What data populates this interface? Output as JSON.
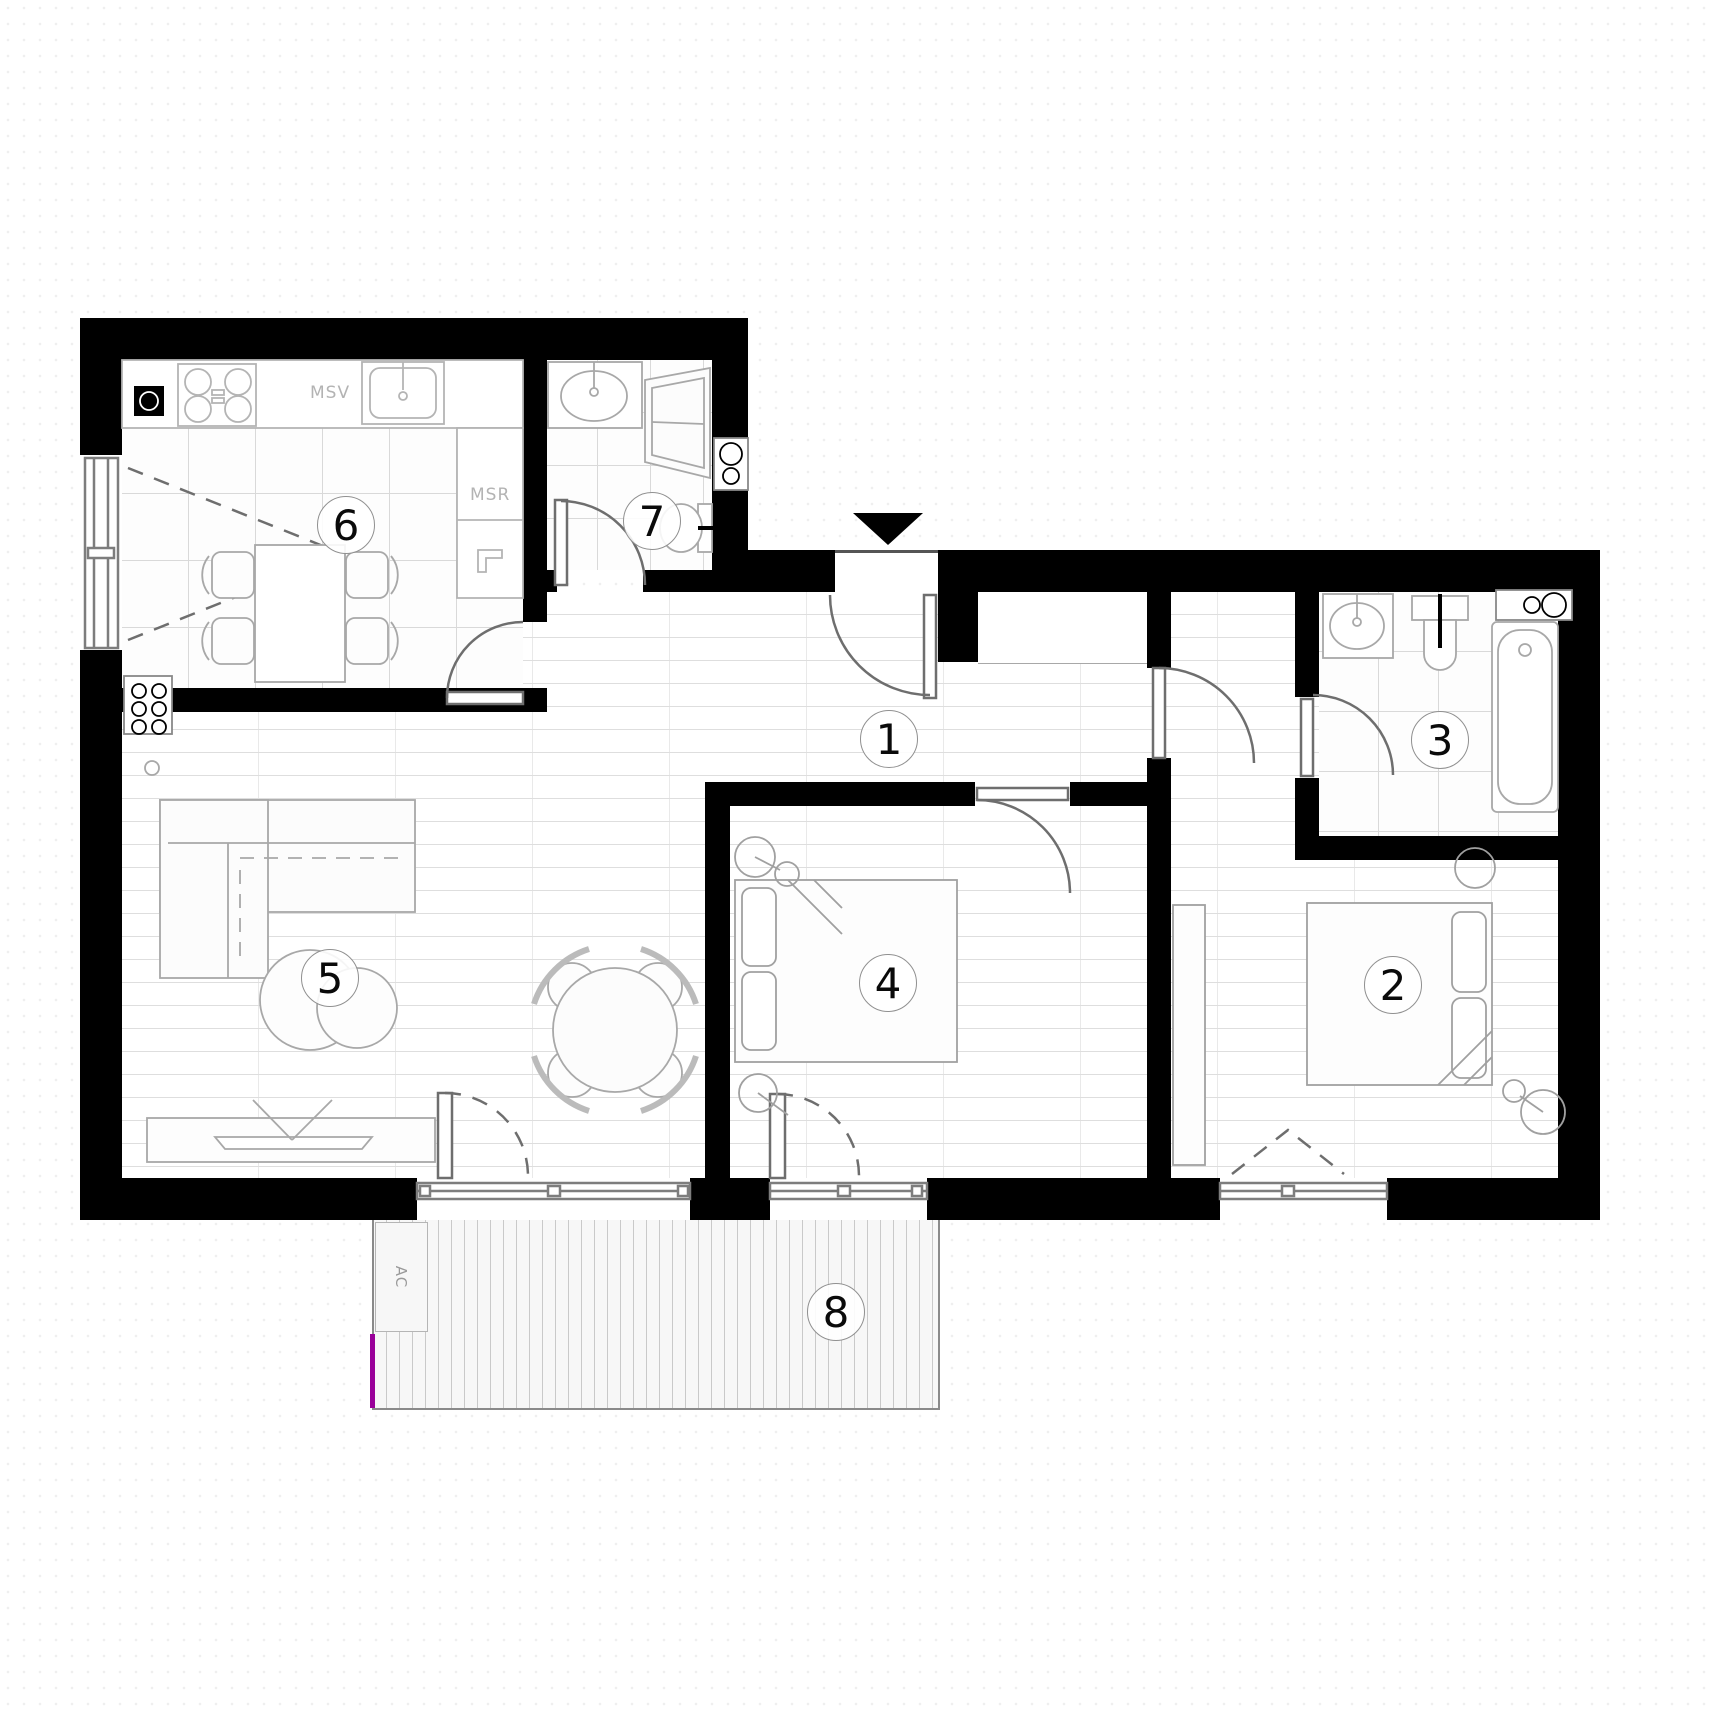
{
  "title": "apartment floor plan",
  "rooms": {
    "r1": {
      "label": "1"
    },
    "r2": {
      "label": "2"
    },
    "r3": {
      "label": "3"
    },
    "r4": {
      "label": "4"
    },
    "r5": {
      "label": "5"
    },
    "r6": {
      "label": "6"
    },
    "r7": {
      "label": "7"
    },
    "r8": {
      "label": "8"
    }
  },
  "annotations": {
    "msv": "MSV",
    "msr": "MSR",
    "ac": "AC"
  },
  "icons": {
    "entrance_arrow": "triangle-down"
  },
  "colors": {
    "wall": "#000000",
    "accent": "#990099",
    "floor_line": "#dcdcdc",
    "fixture_line": "#9a9a9a"
  }
}
